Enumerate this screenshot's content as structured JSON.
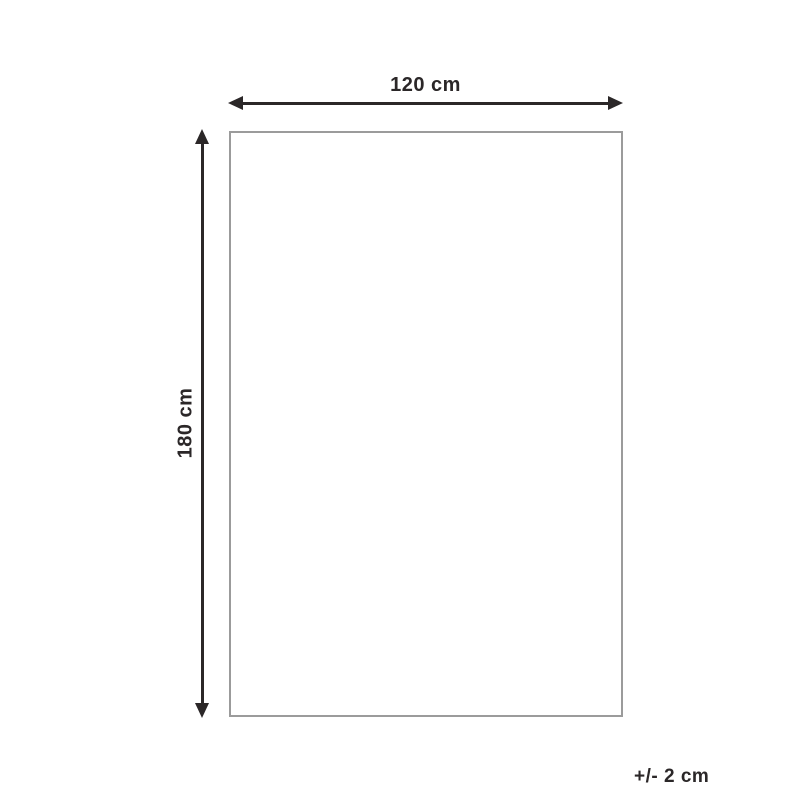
{
  "diagram": {
    "type": "product-dimension-diagram",
    "width_label": "120 cm",
    "height_label": "180 cm",
    "tolerance_label": "+/- 2 cm",
    "colors": {
      "arrow_and_text": "#2b2728",
      "rectangle_border": "#9b9b9b",
      "background": "#ffffff"
    }
  }
}
